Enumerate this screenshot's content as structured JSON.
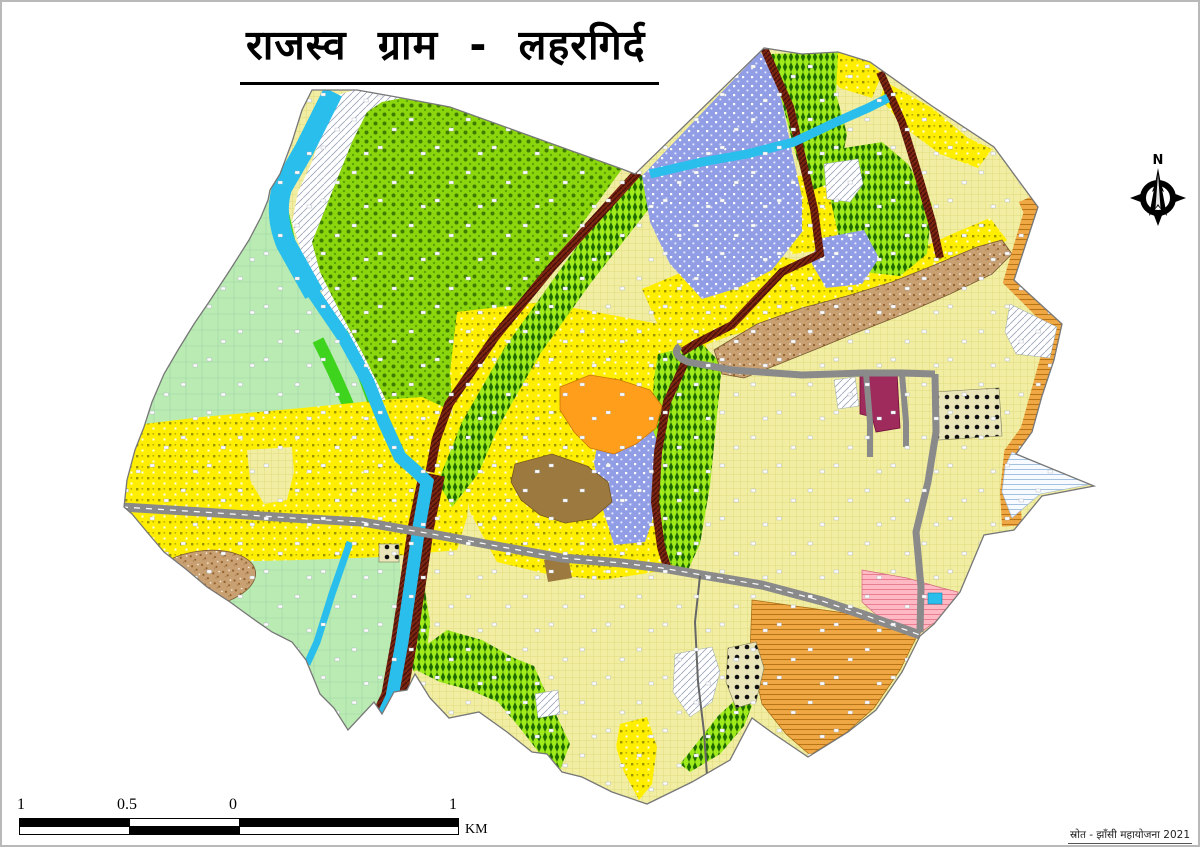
{
  "page": {
    "title": "राजस्व ग्राम - लहरगिर्द",
    "source_note": "स्रोत - झाँसी महायोजना 2021"
  },
  "compass": {
    "north_label": "N"
  },
  "scale_bar": {
    "labels": [
      "1",
      "0.5",
      "0",
      "1"
    ],
    "unit": "KM"
  },
  "map": {
    "village_name": "लहरगिर्द",
    "colors": {
      "river_cyan": "#29BEEB",
      "agriculture_yellow": "#FFEE00",
      "settlement_khaki": "#F1EEA3",
      "dense_plantation_green": "#8CD60E",
      "orchard_green": "#9FEA1A",
      "scrub_purple": "#919EE6",
      "meadow_pale_green": "#B9EBB3",
      "rocky_brown": "#C9A071",
      "builtup_orange": "#FF9E1B",
      "abadi_brown": "#9C7A3F",
      "institutional_maroon": "#9E2B5C",
      "pink_zone": "#FFB9C4",
      "corridor_orange": "#F0A844",
      "kharanja_road_maroon": "#7B2511",
      "metalled_road_gray": "#8A8A8A"
    }
  }
}
